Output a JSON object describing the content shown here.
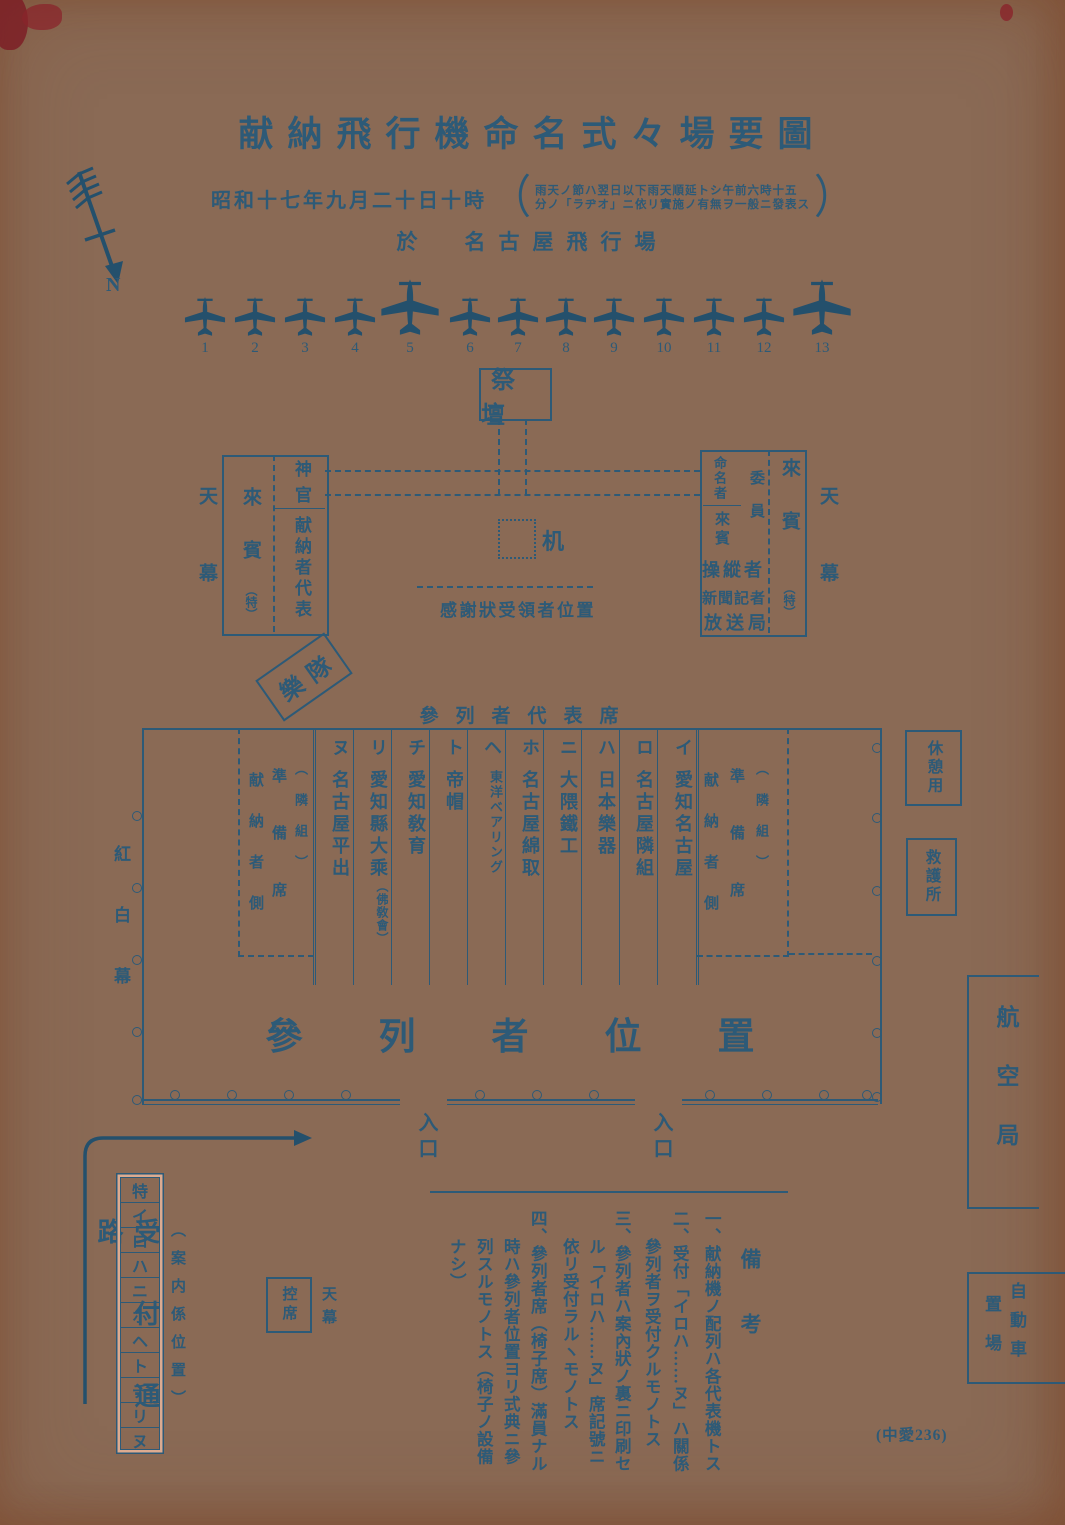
{
  "header": {
    "title": "献納飛行機命名式々場要圖",
    "date": "昭和十七年九月二十日十時",
    "paren_open": "（",
    "paren_close": "）",
    "weather_note_line1": "雨天ノ節ハ翌日以下雨天順延トシ午前六時十五",
    "weather_note_line2": "分ノ「ラヂオ」ニ依リ實施ノ有無ヲ一般ニ發表ス",
    "venue": "於　名古屋飛行場"
  },
  "compass": {
    "north_label": "N"
  },
  "aircraft": {
    "numbers": [
      "1",
      "2",
      "3",
      "4",
      "5",
      "6",
      "7",
      "8",
      "9",
      "10",
      "11",
      "12",
      "13"
    ]
  },
  "ceremony": {
    "altar": "祭壇",
    "desk": "机",
    "thanks_line": "感謝狀受領者位置",
    "band": "樂隊"
  },
  "left_tent": {
    "tent": "天幕",
    "guest": "來賓",
    "guest_note": "（特）",
    "priest": "神官",
    "donor_reps": "献納者代表"
  },
  "right_tent": {
    "tent": "天幕",
    "guest": "來賓",
    "guest_note": "（特）",
    "namer": "命名者",
    "guest2": "來賓",
    "committee": "委員",
    "pilot": "操縱者",
    "press": "新聞記者",
    "broadcast": "放送局"
  },
  "attendee_area": {
    "reps_label": "參列者代表席",
    "curtain": "紅白幕",
    "prep": {
      "side": "献納者側",
      "seats": "準備席",
      "group": "（隣組）"
    },
    "columns": [
      {
        "kana": "ヌ",
        "name": "名古屋平出",
        "sub": ""
      },
      {
        "kana": "リ",
        "name": "愛知縣大乘",
        "sub": "（佛敎會）"
      },
      {
        "kana": "チ",
        "name": "愛知敎育",
        "sub": ""
      },
      {
        "kana": "ト",
        "name": "帝帽",
        "sub": ""
      },
      {
        "kana": "ヘ",
        "name": "東洋ベアリング",
        "sub": ""
      },
      {
        "kana": "ホ",
        "name": "名古屋綿取",
        "sub": ""
      },
      {
        "kana": "ニ",
        "name": "大隈鐵工",
        "sub": ""
      },
      {
        "kana": "ハ",
        "name": "日本樂器",
        "sub": ""
      },
      {
        "kana": "ロ",
        "name": "名古屋隣組",
        "sub": ""
      },
      {
        "kana": "イ",
        "name": "愛知名古屋",
        "sub": ""
      }
    ],
    "area_label": "參列者位置",
    "entrance": "入口"
  },
  "facilities": {
    "rest": "休憩用",
    "aid": "救護所",
    "aviation_bureau": "航空局",
    "parking_col_right": "自動車",
    "parking_col_left": "置場"
  },
  "reception": {
    "path_label": "受付通路",
    "cells": [
      "特",
      "イ",
      "ロ",
      "ハ",
      "ニ",
      "ホ",
      "ヘ",
      "ト",
      "チ",
      "リ",
      "ヌ"
    ],
    "guide_label": "（案内係位置）",
    "waiting": "控席",
    "tent": "天幕"
  },
  "notes": {
    "header": "備考",
    "lines": [
      "一、献納機ノ配列ハ各代表機トス",
      "二、受付「イロハ……ヌ」ハ關係",
      "參列者ヲ受付クルモノトス",
      "三、參列者ハ案內狀ノ裏ニ印刷セ",
      "ル「イロハ……ヌ」席記號ニ",
      "依リ受付ラルヽモノトス",
      "四、參列者席（椅子席）滿員ナル",
      "時ハ參列者位置ヨリ式典ニ參",
      "列スルモノトス（椅子ノ設備",
      "ナシ）"
    ]
  },
  "stamp": "(中愛236)",
  "colors": {
    "ink": "#2d5a77",
    "paper": "#dcab90"
  }
}
